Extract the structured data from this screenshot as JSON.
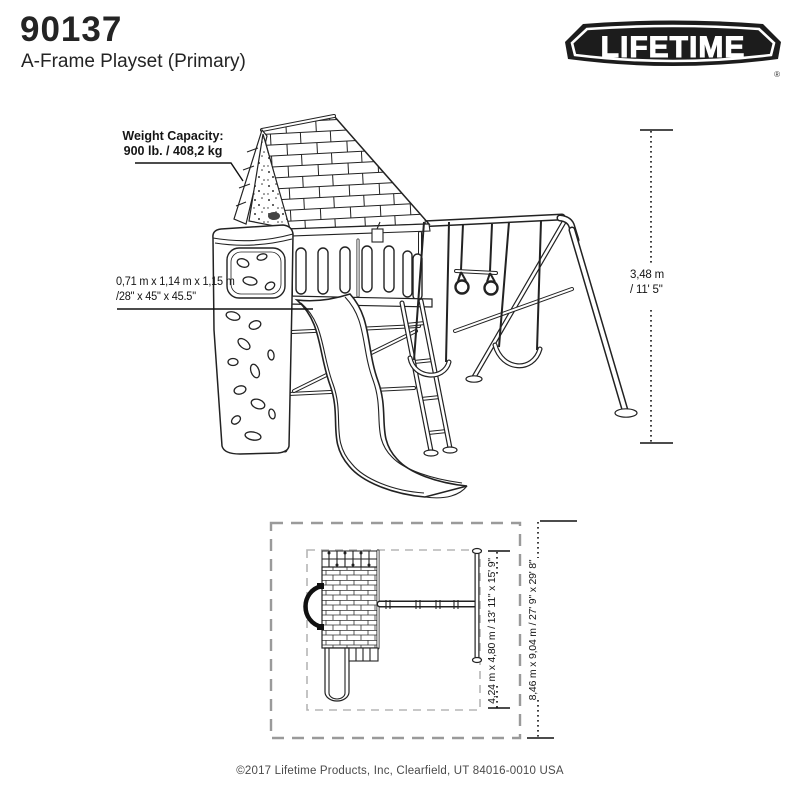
{
  "header": {
    "model_number": "90137",
    "product_title": "A-Frame Playset (Primary)"
  },
  "logo": {
    "brand": "LIFETIME",
    "registered_mark": "®"
  },
  "side_view": {
    "weight_capacity_label": "Weight Capacity:",
    "weight_capacity_value": "900 lb. / 408,2 kg",
    "tower_dimensions_metric": "0,71 m x 1,14 m x 1,15 m",
    "tower_dimensions_imperial": "/28\" x 45\" x 45.5\"",
    "overall_height_metric": "3,48 m",
    "overall_height_imperial": "/ 11' 5\""
  },
  "top_view": {
    "play_area_dimensions": "4,24 m x 4,80 m / 13' 11\" x 15' 9\"",
    "safety_zone_dimensions": "8,46 m x 9,04 m / 27' 9\" x 29' 8\""
  },
  "footer": {
    "copyright": "©2017 Lifetime Products, Inc, Clearfield, UT 84016-0010 USA"
  },
  "colors": {
    "line": "#222222",
    "outer_dash": "#9a9a9a",
    "inner_dash": "#b5b5b5",
    "logo_black": "#1c1c1c"
  }
}
